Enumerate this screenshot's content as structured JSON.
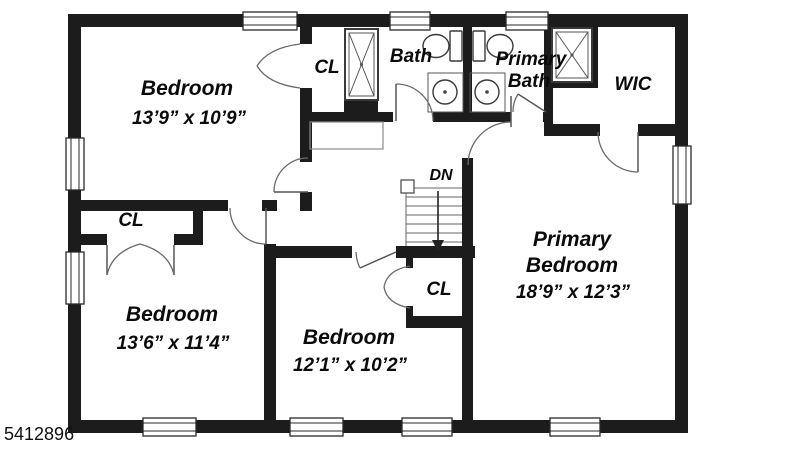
{
  "listing_number": "5412896",
  "colors": {
    "wall": "#1c1c1c",
    "background": "#ffffff",
    "detail_line": "#666666",
    "text": "#0b0b0b"
  },
  "labels": {
    "bedroom_top_left": {
      "name": "Bedroom",
      "dims": "13’9” x 10’9”"
    },
    "bedroom_bottom_left": {
      "name": "Bedroom",
      "dims": "13’6” x 11’4”"
    },
    "bedroom_bottom_mid": {
      "name": "Bedroom",
      "dims": "12’1” x 10’2”"
    },
    "primary_bedroom": {
      "line1": "Primary",
      "line2": "Bedroom",
      "dims": "18’9” x 12’3”"
    },
    "bath": "Bath",
    "primary_bath": {
      "line1": "Primary",
      "line2": "Bath"
    },
    "wic": "WIC",
    "closet_top": "CL",
    "closet_left": "CL",
    "closet_under_stairs": "CL",
    "stairs_direction": "DN"
  }
}
